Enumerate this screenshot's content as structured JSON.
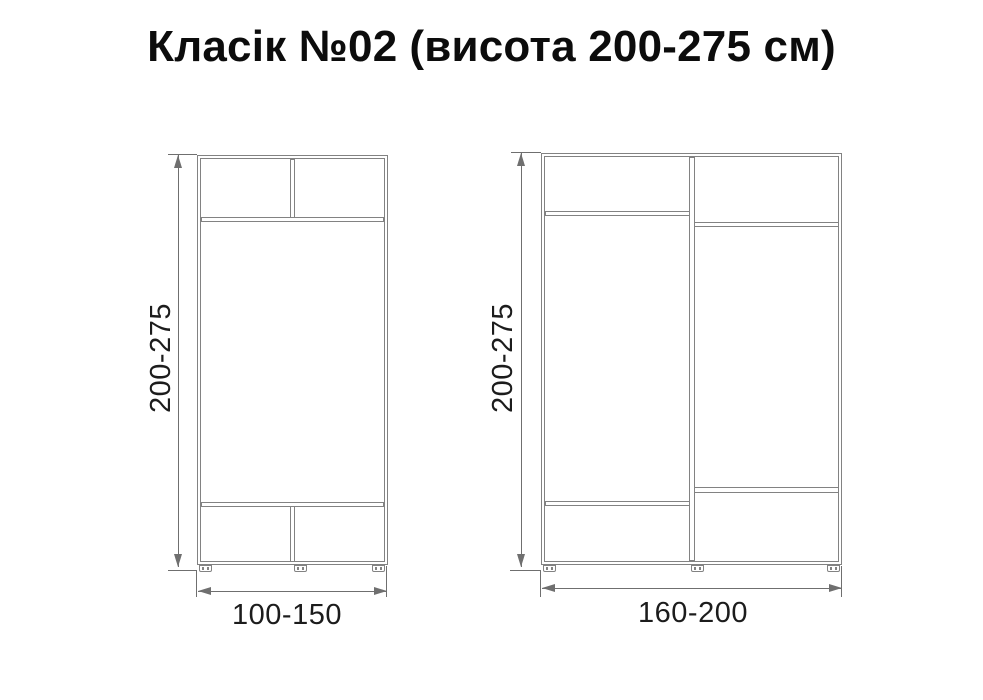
{
  "title": {
    "main": "Класік №02",
    "suffix": "(висота 200-275 см)"
  },
  "cabinets": {
    "small": {
      "height_label": "200-275",
      "width_label": "100-150"
    },
    "large": {
      "height_label": "200-275",
      "width_label": "160-200"
    }
  },
  "colors": {
    "drawing_line": "#828282",
    "dimension_line": "#6f6f6f",
    "label_text": "#1c1c1c",
    "title_text": "#0c0c0c",
    "background": "#ffffff"
  }
}
